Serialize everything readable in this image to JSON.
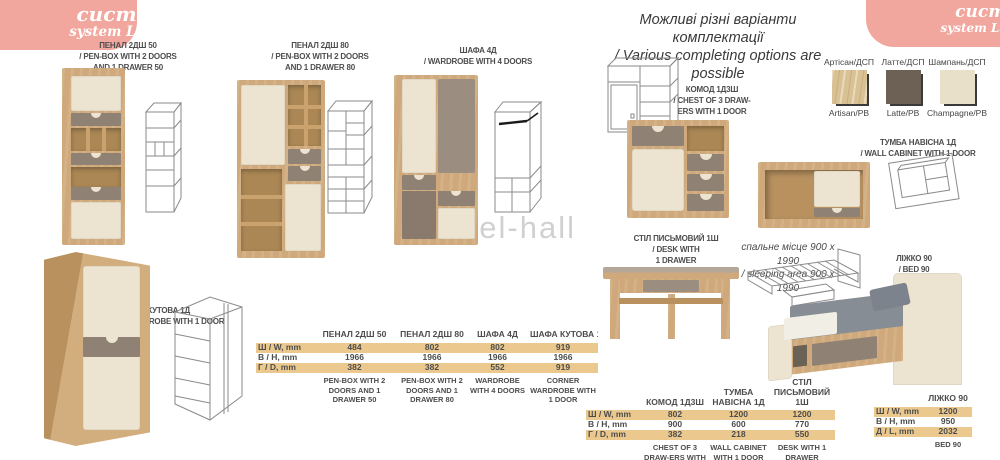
{
  "banner": {
    "title": "система Ламі",
    "subtitle": "system Lami"
  },
  "header_note": {
    "line1": "Можливі різні варіанти комплектації",
    "line2": "/ Various completing options are possible"
  },
  "watermark": "mebel-hall",
  "colors": {
    "pink": "#f1a69e",
    "wood": "#cfa97b",
    "latte": "#6d6055",
    "champagne": "#e9e0ca",
    "row_highlight": "#ebc98e"
  },
  "swatches": [
    {
      "name_uk": "Артісан/ДСП",
      "name_en": "Artisan/PB",
      "color": "#d9c193"
    },
    {
      "name_uk": "Латте/ДСП",
      "name_en": "Latte/PB",
      "color": "#6d6055"
    },
    {
      "name_uk": "Шампань/ДСП",
      "name_en": "Champagne/PB",
      "color": "#e9e0ca"
    }
  ],
  "products": {
    "penbox50": {
      "lines": [
        "ПЕНАЛ 2ДШ 50",
        "/ PEN-BOX WITH 2 DOORS",
        "AND 1 DRAWER 50"
      ]
    },
    "penbox80": {
      "lines": [
        "ПЕНАЛ 2ДШ 80",
        "/ PEN-BOX WITH 2 DOORS",
        "AND 1 DRAWER 80"
      ]
    },
    "wardrobe4": {
      "lines": [
        "ШАФА 4Д",
        "/ WARDROBE WITH 4 DOORS"
      ]
    },
    "corner": {
      "lines": [
        "ШАФА КУТОВА 1Д",
        "/ CORNER WARDROBE WITH 1 DOOR"
      ]
    },
    "chest": {
      "lines": [
        "КОМОД 1Д3Ш",
        "/ CHEST OF 3 DRAW-",
        "ERS WITH 1 DOOR"
      ]
    },
    "wallcab": {
      "lines": [
        "ТУМБА НАВІСНА 1Д",
        "/ WALL CABINET WITH 1 DOOR"
      ]
    },
    "desk": {
      "lines": [
        "СТІЛ ПИСЬМОВИЙ 1Ш",
        "/ DESK WITH",
        "1 DRAWER"
      ]
    },
    "bed": {
      "lines": [
        "ЛІЖКО 90",
        "/ BED 90"
      ]
    }
  },
  "bed_note": {
    "line1": "спальне місце 900 х 1990",
    "line2": "/ sleeping area 900 х 1990"
  },
  "chart_data": [
    {
      "type": "table",
      "columns": [
        "ПЕНАЛ 2ДШ 50",
        "ПЕНАЛ 2ДШ 80",
        "ШАФА 4Д",
        "ШАФА КУТОВА 1Д"
      ],
      "row_labels": [
        "Ш / W, mm",
        "В / H, mm",
        "Г / D, mm"
      ],
      "rows": [
        [
          484,
          802,
          802,
          919
        ],
        [
          1966,
          1966,
          1966,
          1966
        ],
        [
          382,
          382,
          552,
          919
        ]
      ],
      "footers": [
        "PEN-BOX WITH 2 DOORS AND 1 DRAWER 50",
        "PEN-BOX WITH 2 DOORS AND 1 DRAWER 80",
        "WARDROBE WITH 4 DOORS",
        "CORNER WARDROBE WITH 1 DOOR"
      ]
    },
    {
      "type": "table",
      "columns": [
        "КОМОД 1Д3Ш",
        "ТУМБА НАВІСНА 1Д",
        "СТІЛ ПИСЬМОВИЙ 1Ш"
      ],
      "row_labels": [
        "Ш / W, mm",
        "В / H, mm",
        "Г / D, mm"
      ],
      "rows": [
        [
          802,
          1200,
          1200
        ],
        [
          900,
          600,
          770
        ],
        [
          382,
          218,
          550
        ]
      ],
      "footers": [
        "CHEST OF 3 DRAW-ERS WITH 1 DOOR",
        "WALL CABINET WITH 1 DOOR",
        "DESK WITH 1 DRAWER"
      ]
    },
    {
      "type": "table",
      "columns": [
        "ЛІЖКО 90"
      ],
      "row_labels": [
        "Ш / W, mm",
        "В / H, mm",
        "Д / L, mm"
      ],
      "rows": [
        [
          1200
        ],
        [
          950
        ],
        [
          2032
        ]
      ],
      "footers": [
        "BED 90"
      ]
    }
  ]
}
